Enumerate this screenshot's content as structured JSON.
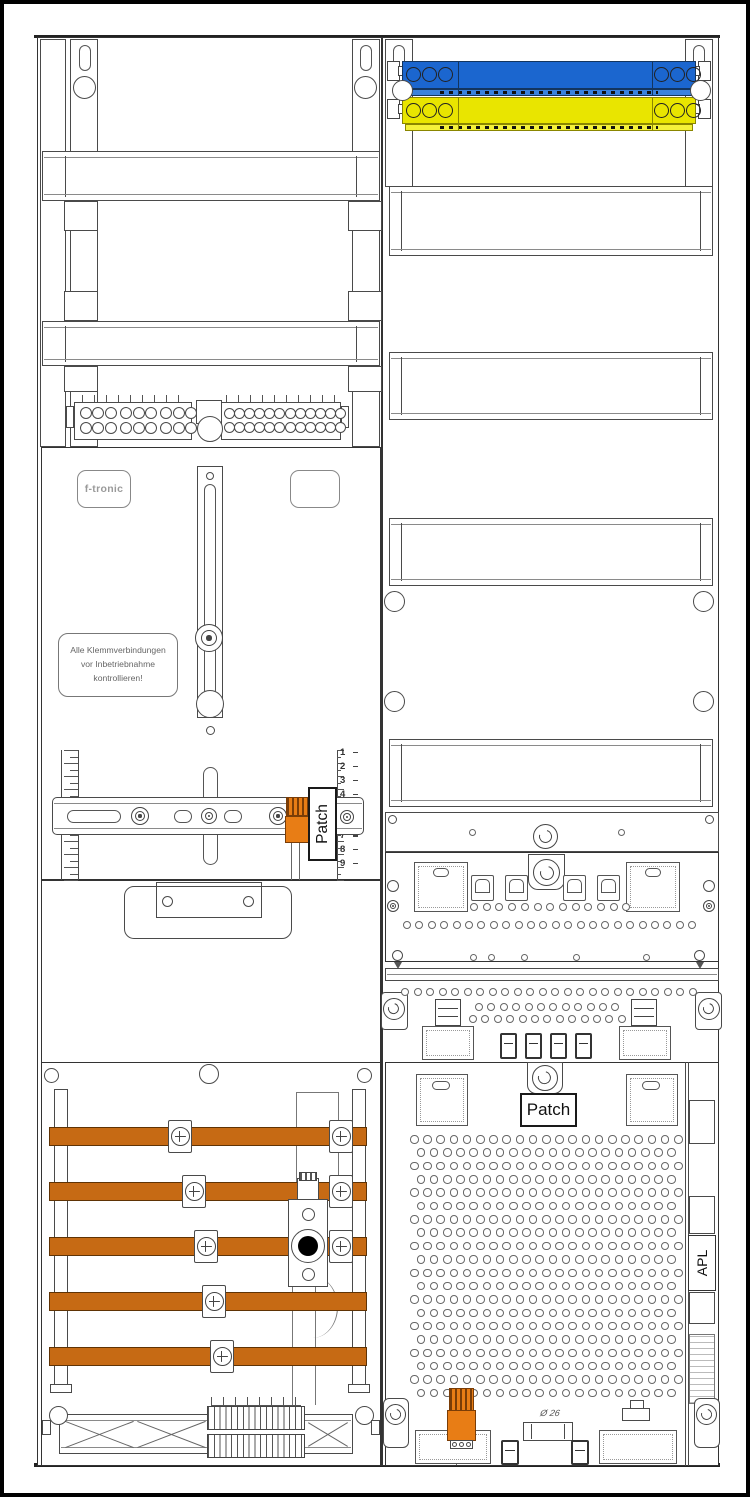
{
  "drawing": {
    "brand": "f-tronic",
    "warning_lines": [
      "Alle Klemmverbindungen",
      "vor Inbetriebnahme",
      "kontrollieren!"
    ],
    "patch_label_left": "Patch",
    "patch_label_right": "Patch",
    "apl_label": "APL",
    "diameter_label": "Ø 26",
    "ruler_numbers": [
      "1",
      "2",
      "3",
      "4",
      "5",
      "6",
      "7",
      "8",
      "9"
    ]
  },
  "colors": {
    "neutral_busbar_blue": "#1b66cf",
    "neutral_busbar_blue_flange": "#3b82dd",
    "pe_busbar_yellow": "#e9e500",
    "pe_busbar_yellow_flange": "#f4f13a",
    "copper_busbar": "#c66a14",
    "copper_busbar_edge": "#5f3305",
    "orange_component": "#e87d15",
    "orange_component_edge": "#7a3d07"
  },
  "patterns": {
    "hole_rows": [
      {
        "y": 899,
        "x0": 466,
        "dx": 12.7,
        "n": 13,
        "d": 8
      },
      {
        "y": 917,
        "x0": 399,
        "dx": 12.4,
        "n": 24,
        "d": 8
      },
      {
        "y": 984,
        "x0": 397,
        "dx": 12.5,
        "n": 24,
        "d": 8
      },
      {
        "y": 999,
        "x0": 471,
        "dx": 12.4,
        "n": 12,
        "d": 8
      },
      {
        "y": 1011,
        "x0": 465,
        "dx": 12.4,
        "n": 13,
        "d": 8
      },
      {
        "y": 950,
        "xs": [
          466,
          484,
          517,
          569,
          639
        ],
        "d": 7
      },
      {
        "y": 825,
        "xs": [
          465,
          614
        ],
        "d": 7
      }
    ],
    "perforation": {
      "x0": 406,
      "y0": 1131,
      "dx": 13.2,
      "dy": 13.35,
      "rows": 20,
      "cols": 21,
      "offset": 6.6,
      "d": 8.5
    },
    "terminal_blocks": [
      {
        "x": 76,
        "y": 403,
        "cols": 9,
        "rows": 2,
        "dx": 12.4,
        "dy": 14.5,
        "d": 12,
        "group": 3,
        "gap": 3
      },
      {
        "x": 220,
        "y": 404,
        "cols": 12,
        "rows": 2,
        "dx": 9.9,
        "dy": 13.5,
        "d": 11,
        "group": 6,
        "gap": 2
      }
    ],
    "busbar_circles": {
      "d": 15,
      "dx": 16,
      "left_x": 402,
      "right_x": 650,
      "blue_y": 63,
      "yellow_y": 99,
      "n": 3
    },
    "copper": {
      "x": 45,
      "w": 318,
      "h": 19,
      "bars": [
        {
          "y": 1123,
          "clamps": [
            176,
            337
          ]
        },
        {
          "y": 1178,
          "clamps": [
            190,
            337
          ]
        },
        {
          "y": 1233,
          "clamps": [
            202,
            337
          ]
        },
        {
          "y": 1288,
          "clamps": [
            210
          ]
        },
        {
          "y": 1343,
          "clamps": [
            218
          ]
        }
      ]
    },
    "rulers": {
      "y0": 746,
      "len": 130,
      "tick_dy": 6.5,
      "left_x": 57,
      "left_edge_x": 74,
      "right_x": 333,
      "num_x": 336,
      "num_y0": 748,
      "num_dy": 13.9
    },
    "comb": {
      "x": 203,
      "w": 98,
      "rows_y": [
        1402,
        1430
      ],
      "row_h": 24
    },
    "clips_a": {
      "y": 871,
      "w": 23,
      "h": 26,
      "xs": [
        467,
        501,
        559,
        593
      ]
    },
    "clips_b": {
      "y": 1029,
      "w": 17,
      "h": 26,
      "xs": [
        496,
        521,
        546,
        571
      ]
    },
    "clips_c": {
      "y": 1436,
      "w": 18,
      "h": 25,
      "xs": [
        497,
        567
      ]
    }
  }
}
